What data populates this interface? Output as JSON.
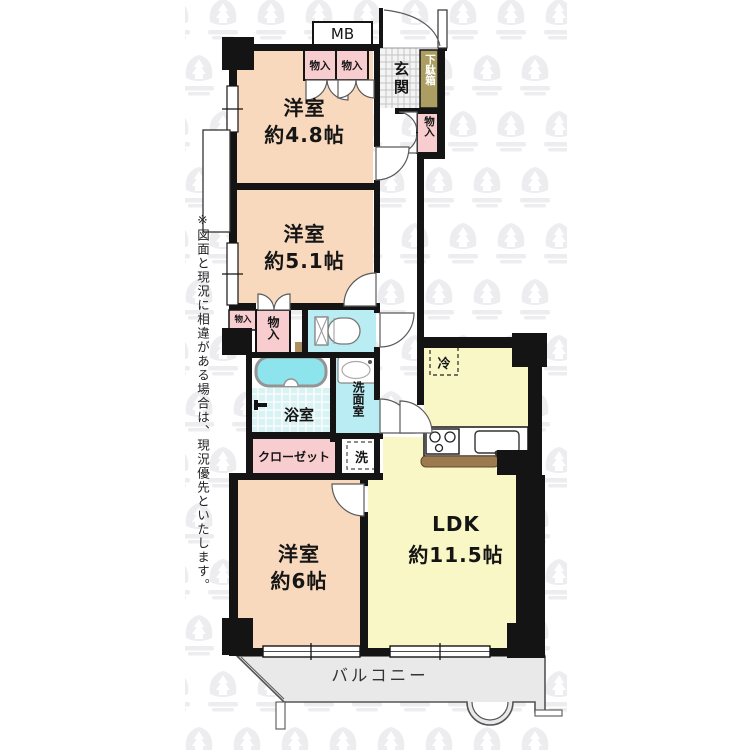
{
  "disclaimer": {
    "text": "※図面と現況に相違がある場合は、現況優先といたします。"
  },
  "rooms": {
    "bedroom_48": {
      "label": "洋室",
      "size": "約4.8帖"
    },
    "bedroom_51": {
      "label": "洋室",
      "size": "約5.1帖"
    },
    "bedroom_6": {
      "label": "洋室",
      "size": "約6帖"
    },
    "ldk": {
      "label": "LDK",
      "size": "約11.5帖"
    },
    "entrance": {
      "label": "玄関"
    },
    "bathroom": {
      "label": "浴室"
    },
    "washroom": {
      "label": "洗面室"
    },
    "closet": {
      "label": "クローゼット"
    },
    "balcony": {
      "label": "バルコニー"
    }
  },
  "features": {
    "meter_box": {
      "label": "MB"
    },
    "shoe_cabinet": {
      "label": "下駄箱"
    },
    "storage_top_left": {
      "label": "物入"
    },
    "storage_top_right": {
      "label": "物入"
    },
    "storage_entry": {
      "label": "物入"
    },
    "storage_hall": {
      "label": "物入"
    },
    "storage_hall_small": {
      "label": "物入"
    },
    "washer_space": {
      "label": "洗"
    },
    "refrigerator_space": {
      "label": "冷"
    }
  },
  "colors": {
    "wall": "#141414",
    "bedroom_fill": "#f8d9bd",
    "ldk_fill": "#f9f7c5",
    "pink_fill": "#f8cdd0",
    "water_fill": "#b9ecf3",
    "bath_floor": "#d9f3f5",
    "tub_fill": "#8ee4ec",
    "shoe_cabinet_fill": "#ac9e62",
    "counter_fill": "#9a7a4e",
    "balcony_fill": "#e9e9e9",
    "watermark_tile": "#ededf0"
  }
}
